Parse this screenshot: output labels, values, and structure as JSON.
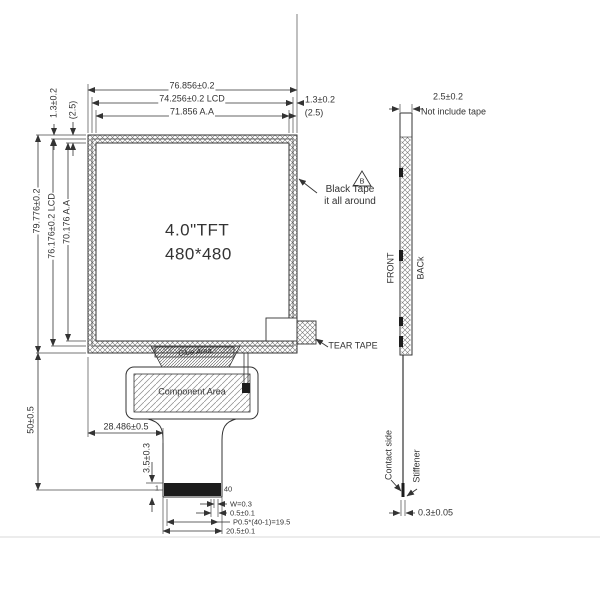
{
  "front": {
    "display": {
      "line1": "4.0\"TFT",
      "line2": "480*480"
    },
    "dims_top": {
      "overall": "76.856±0.2",
      "lcd": "74.256±0.2 LCD",
      "aa": "71.856 A.A",
      "border": "1.3±0.2",
      "aa_margin": "(2.5)"
    },
    "dims_left": {
      "border": "1.3±0.2",
      "aa_margin": "(2.5)",
      "overall": "79.776±0.2",
      "lcd": "76.176±0.2 LCD",
      "aa": "70.176 A.A"
    },
    "dims_bottom": {
      "fpc_length": "50±0.5",
      "fpc_offset": "28.486±0.5",
      "contact_length": "3.5±0.3",
      "pin_first": "1",
      "pin_last": "40",
      "pad_width": "W=0.3",
      "pitch": "0.5±0.1",
      "pitch_total": "P0.5*(40-1)=19.5",
      "tail_width": "20.5±0.1"
    },
    "labels": {
      "black_tape_symbol": "B",
      "black_tape_line1": "Black Tape",
      "black_tape_line2": "it  all around",
      "tear_tape": "TEAR TAPE",
      "glue_area": "Glue Area",
      "component_area": "Component Area"
    }
  },
  "side": {
    "labels": {
      "front": "FRONT",
      "back": "BACk",
      "contact_side": "Contact side",
      "stiffener": "Stiffener"
    },
    "dims": {
      "thickness": "2.5±0.2",
      "thickness_note": "Not include tape",
      "stiffener_thickness": "0.3±0.05"
    }
  },
  "colors": {
    "line": "#333333",
    "text": "#333333",
    "contact_bar": "#1c1c1c",
    "background": "#ffffff"
  }
}
